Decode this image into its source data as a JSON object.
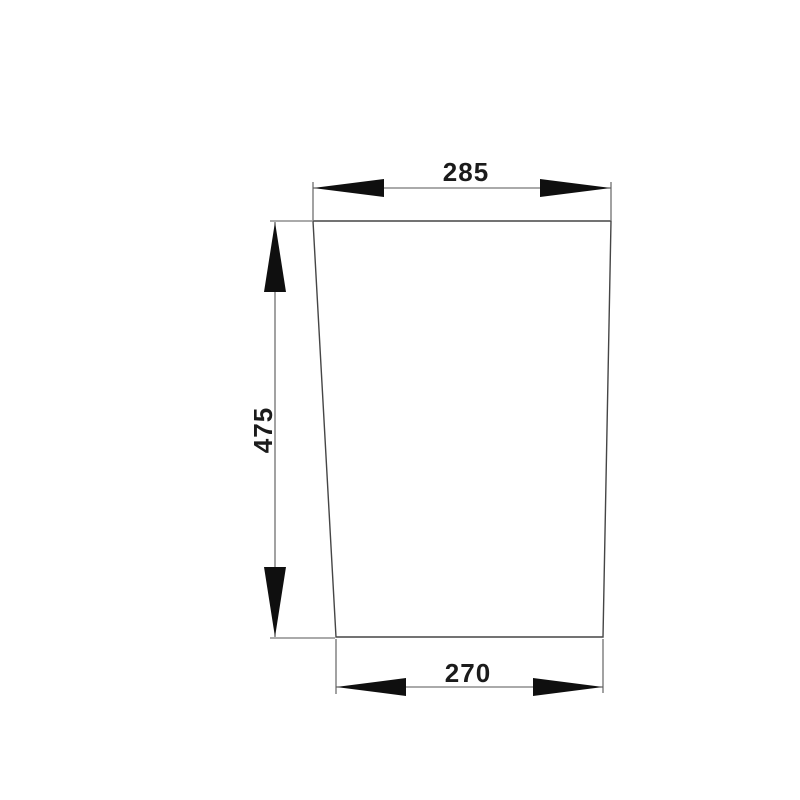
{
  "drawing": {
    "kind": "part-dimension-drawing",
    "dimensions": {
      "top": {
        "label": "285"
      },
      "left": {
        "label": "475"
      },
      "bottom": {
        "label": "270"
      }
    },
    "colors": {
      "background": "#ffffff",
      "outline": "#454545",
      "line": "#565656",
      "arrow": "#0f0f0f",
      "text": "#1b1b1b"
    }
  }
}
